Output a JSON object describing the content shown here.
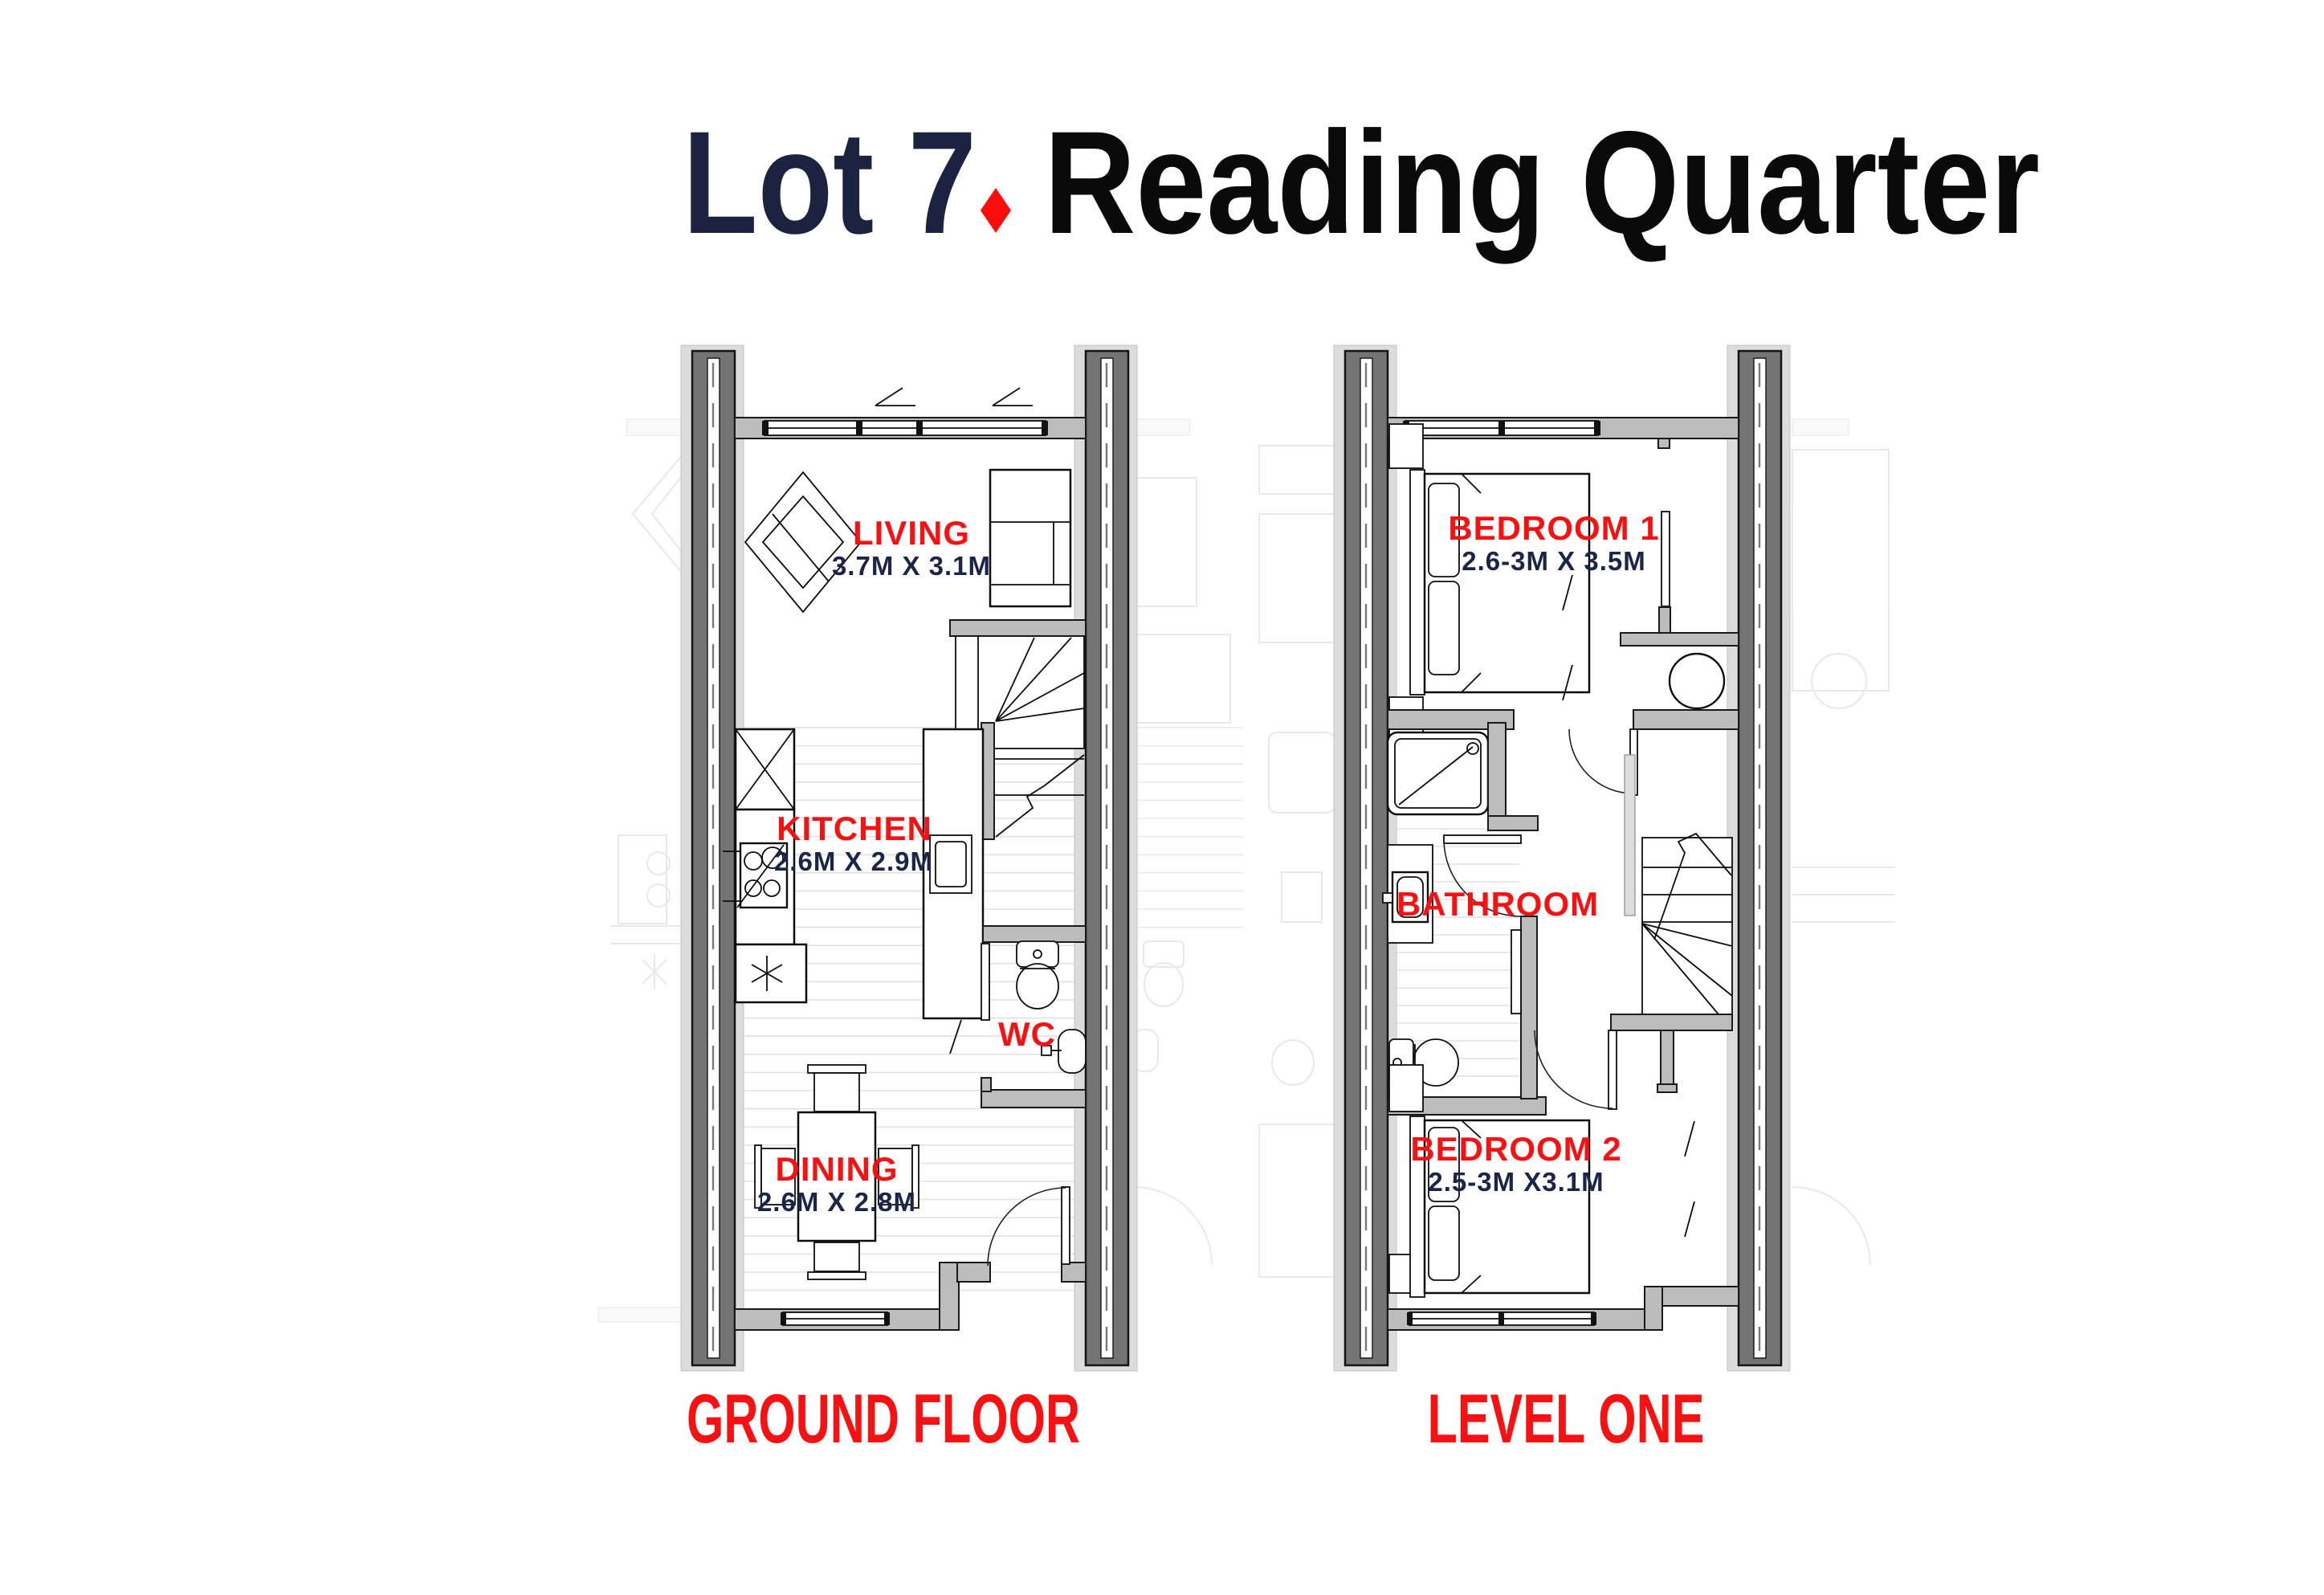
{
  "title": {
    "lot": "Lot 7",
    "project": "Reading Quarter"
  },
  "colors": {
    "accent_red": "#F61212",
    "navy": "#1B2547",
    "title_black": "#0A0A0A",
    "wall_dark": "#747474",
    "wall_light": "#BCBCBC",
    "floor_line": "#E2E2E2"
  },
  "floors": [
    {
      "label": "GROUND FLOOR",
      "rooms": [
        {
          "name": "LIVING",
          "dims": "3.7M X 3.1M"
        },
        {
          "name": "KITCHEN",
          "dims": "2.6M X 2.9M"
        },
        {
          "name": "WC",
          "dims": ""
        },
        {
          "name": "DINING",
          "dims": "2.6M X 2.8M"
        }
      ]
    },
    {
      "label": "LEVEL ONE",
      "rooms": [
        {
          "name": "BEDROOM 1",
          "dims": "2.6-3M X 3.5M"
        },
        {
          "name": "BATHROOM",
          "dims": ""
        },
        {
          "name": "BEDROOM 2",
          "dims": "2.5-3M X3.1M"
        }
      ]
    }
  ]
}
